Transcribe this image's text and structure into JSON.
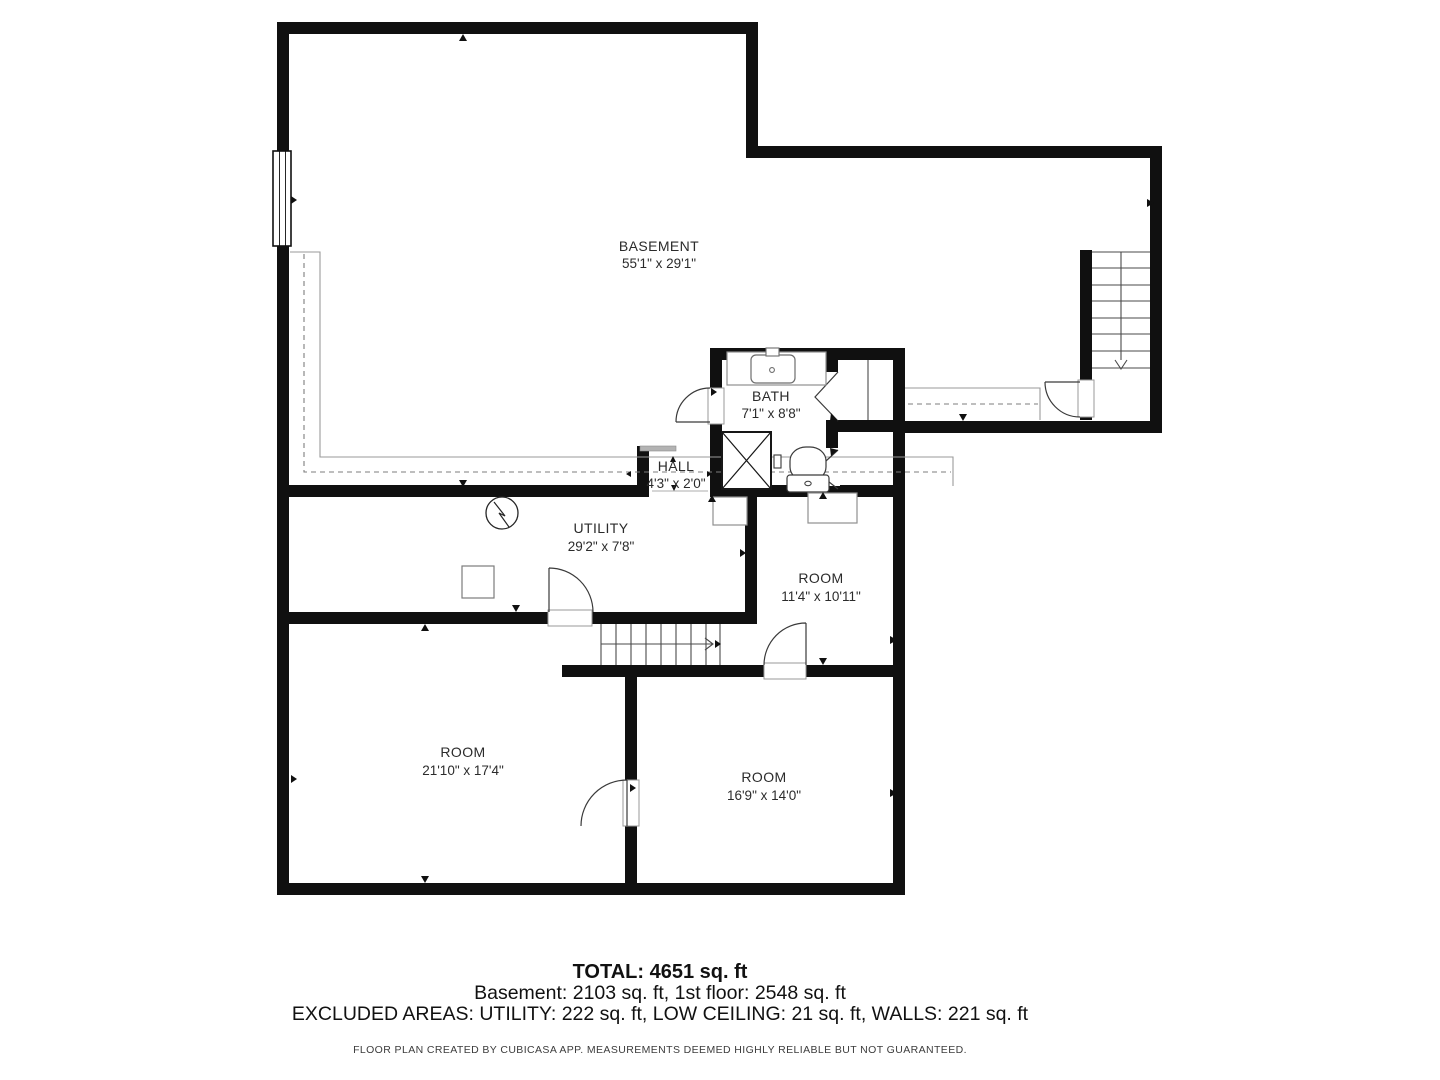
{
  "floorplan": {
    "rooms": [
      {
        "name": "BASEMENT",
        "dims": "55'1\" x 29'1\""
      },
      {
        "name": "BATH",
        "dims": "7'1\" x 8'8\""
      },
      {
        "name": "HALL",
        "dims": "4'3\" x 2'0\""
      },
      {
        "name": "UTILITY",
        "dims": "29'2\" x 7'8\""
      },
      {
        "name": "ROOM",
        "dims": "11'4\" x 10'11\""
      },
      {
        "name": "ROOM",
        "dims": "21'10\" x 17'4\""
      },
      {
        "name": "ROOM",
        "dims": "16'9\" x 14'0\""
      }
    ]
  },
  "summary": {
    "total": "TOTAL: 4651 sq. ft",
    "floors": "Basement: 2103 sq. ft, 1st floor: 2548 sq. ft",
    "excluded": "EXCLUDED AREAS: UTILITY: 222 sq. ft, LOW CEILING: 21 sq. ft, WALLS: 221 sq. ft",
    "disclaimer": "FLOOR PLAN CREATED BY CUBICASA APP. MEASUREMENTS DEEMED HIGHLY RELIABLE BUT NOT GUARANTEED."
  },
  "colors": {
    "wall": "#101010",
    "background": "#ffffff",
    "furniture_line": "#8f8f8f",
    "low_ceiling_dash": "#7d7d7d",
    "text": "#2b2b2b"
  }
}
